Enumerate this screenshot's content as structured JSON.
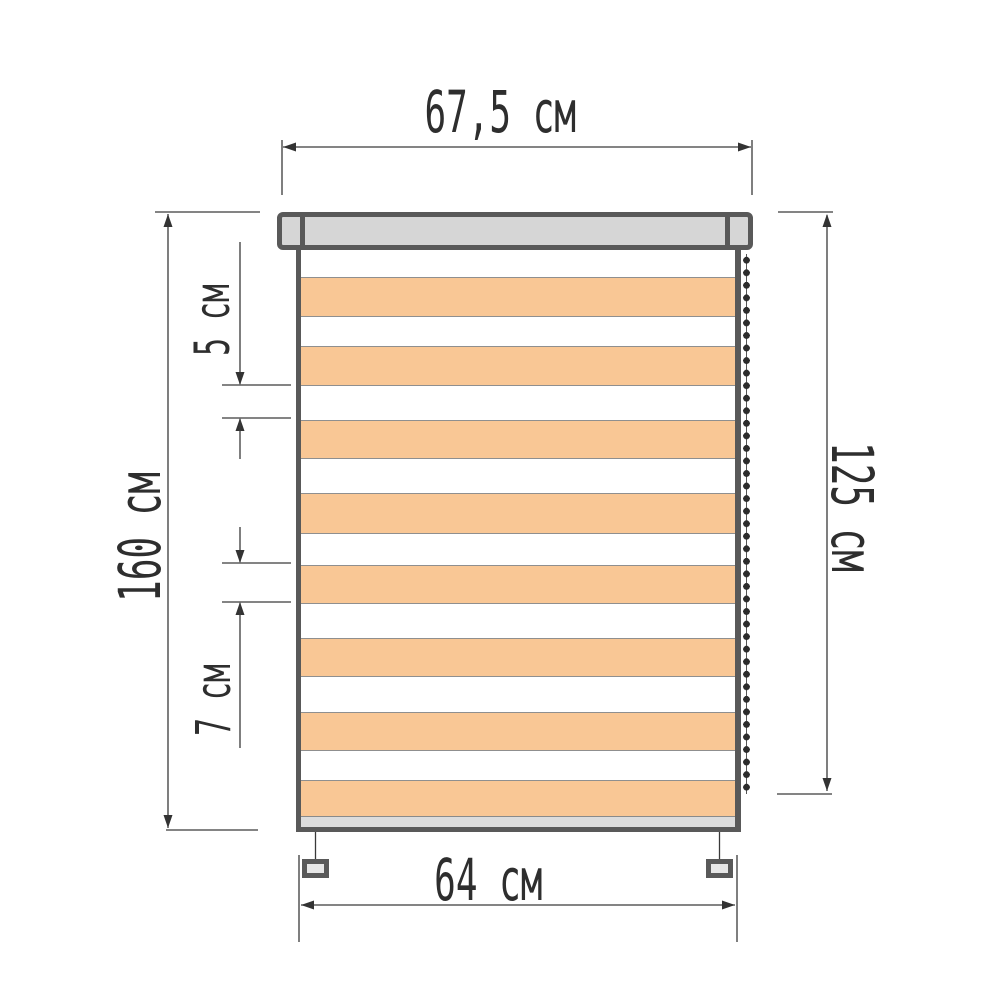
{
  "labels": {
    "cassette_width": "67,5 см",
    "full_height": "160 см",
    "light_stripe": "5 см",
    "dark_stripe": "7 см",
    "fabric_height": "125 см",
    "fabric_width": "64 см"
  },
  "colors": {
    "stripe_orange": "#f9c795",
    "stripe_white": "#ffffff",
    "frame_dark": "#595959",
    "cassette_fill": "#d6d6d6",
    "rail_fill": "#dcdcdc",
    "bracket_fill": "#e6e6e6",
    "dimension_line": "#3a3a3a",
    "text": "#2e2e2e",
    "chain_dot": "#2c2c2c"
  },
  "blind": {
    "orange_stripe_count": 8,
    "white_stripe_count": 8,
    "chain_side": "right",
    "bracket_count": 2,
    "stripes": [
      {
        "color": "white",
        "h": 24
      },
      {
        "color": "orange",
        "h": 39
      },
      {
        "color": "white",
        "h": 30
      },
      {
        "color": "orange",
        "h": 39
      },
      {
        "color": "white",
        "h": 35
      },
      {
        "color": "orange",
        "h": 38
      },
      {
        "color": "white",
        "h": 35
      },
      {
        "color": "orange",
        "h": 40
      },
      {
        "color": "white",
        "h": 32
      },
      {
        "color": "orange",
        "h": 38
      },
      {
        "color": "white",
        "h": 35
      },
      {
        "color": "orange",
        "h": 38
      },
      {
        "color": "white",
        "h": 36
      },
      {
        "color": "orange",
        "h": 38
      },
      {
        "color": "white",
        "h": 30
      },
      {
        "color": "orange",
        "h": 36
      }
    ]
  }
}
